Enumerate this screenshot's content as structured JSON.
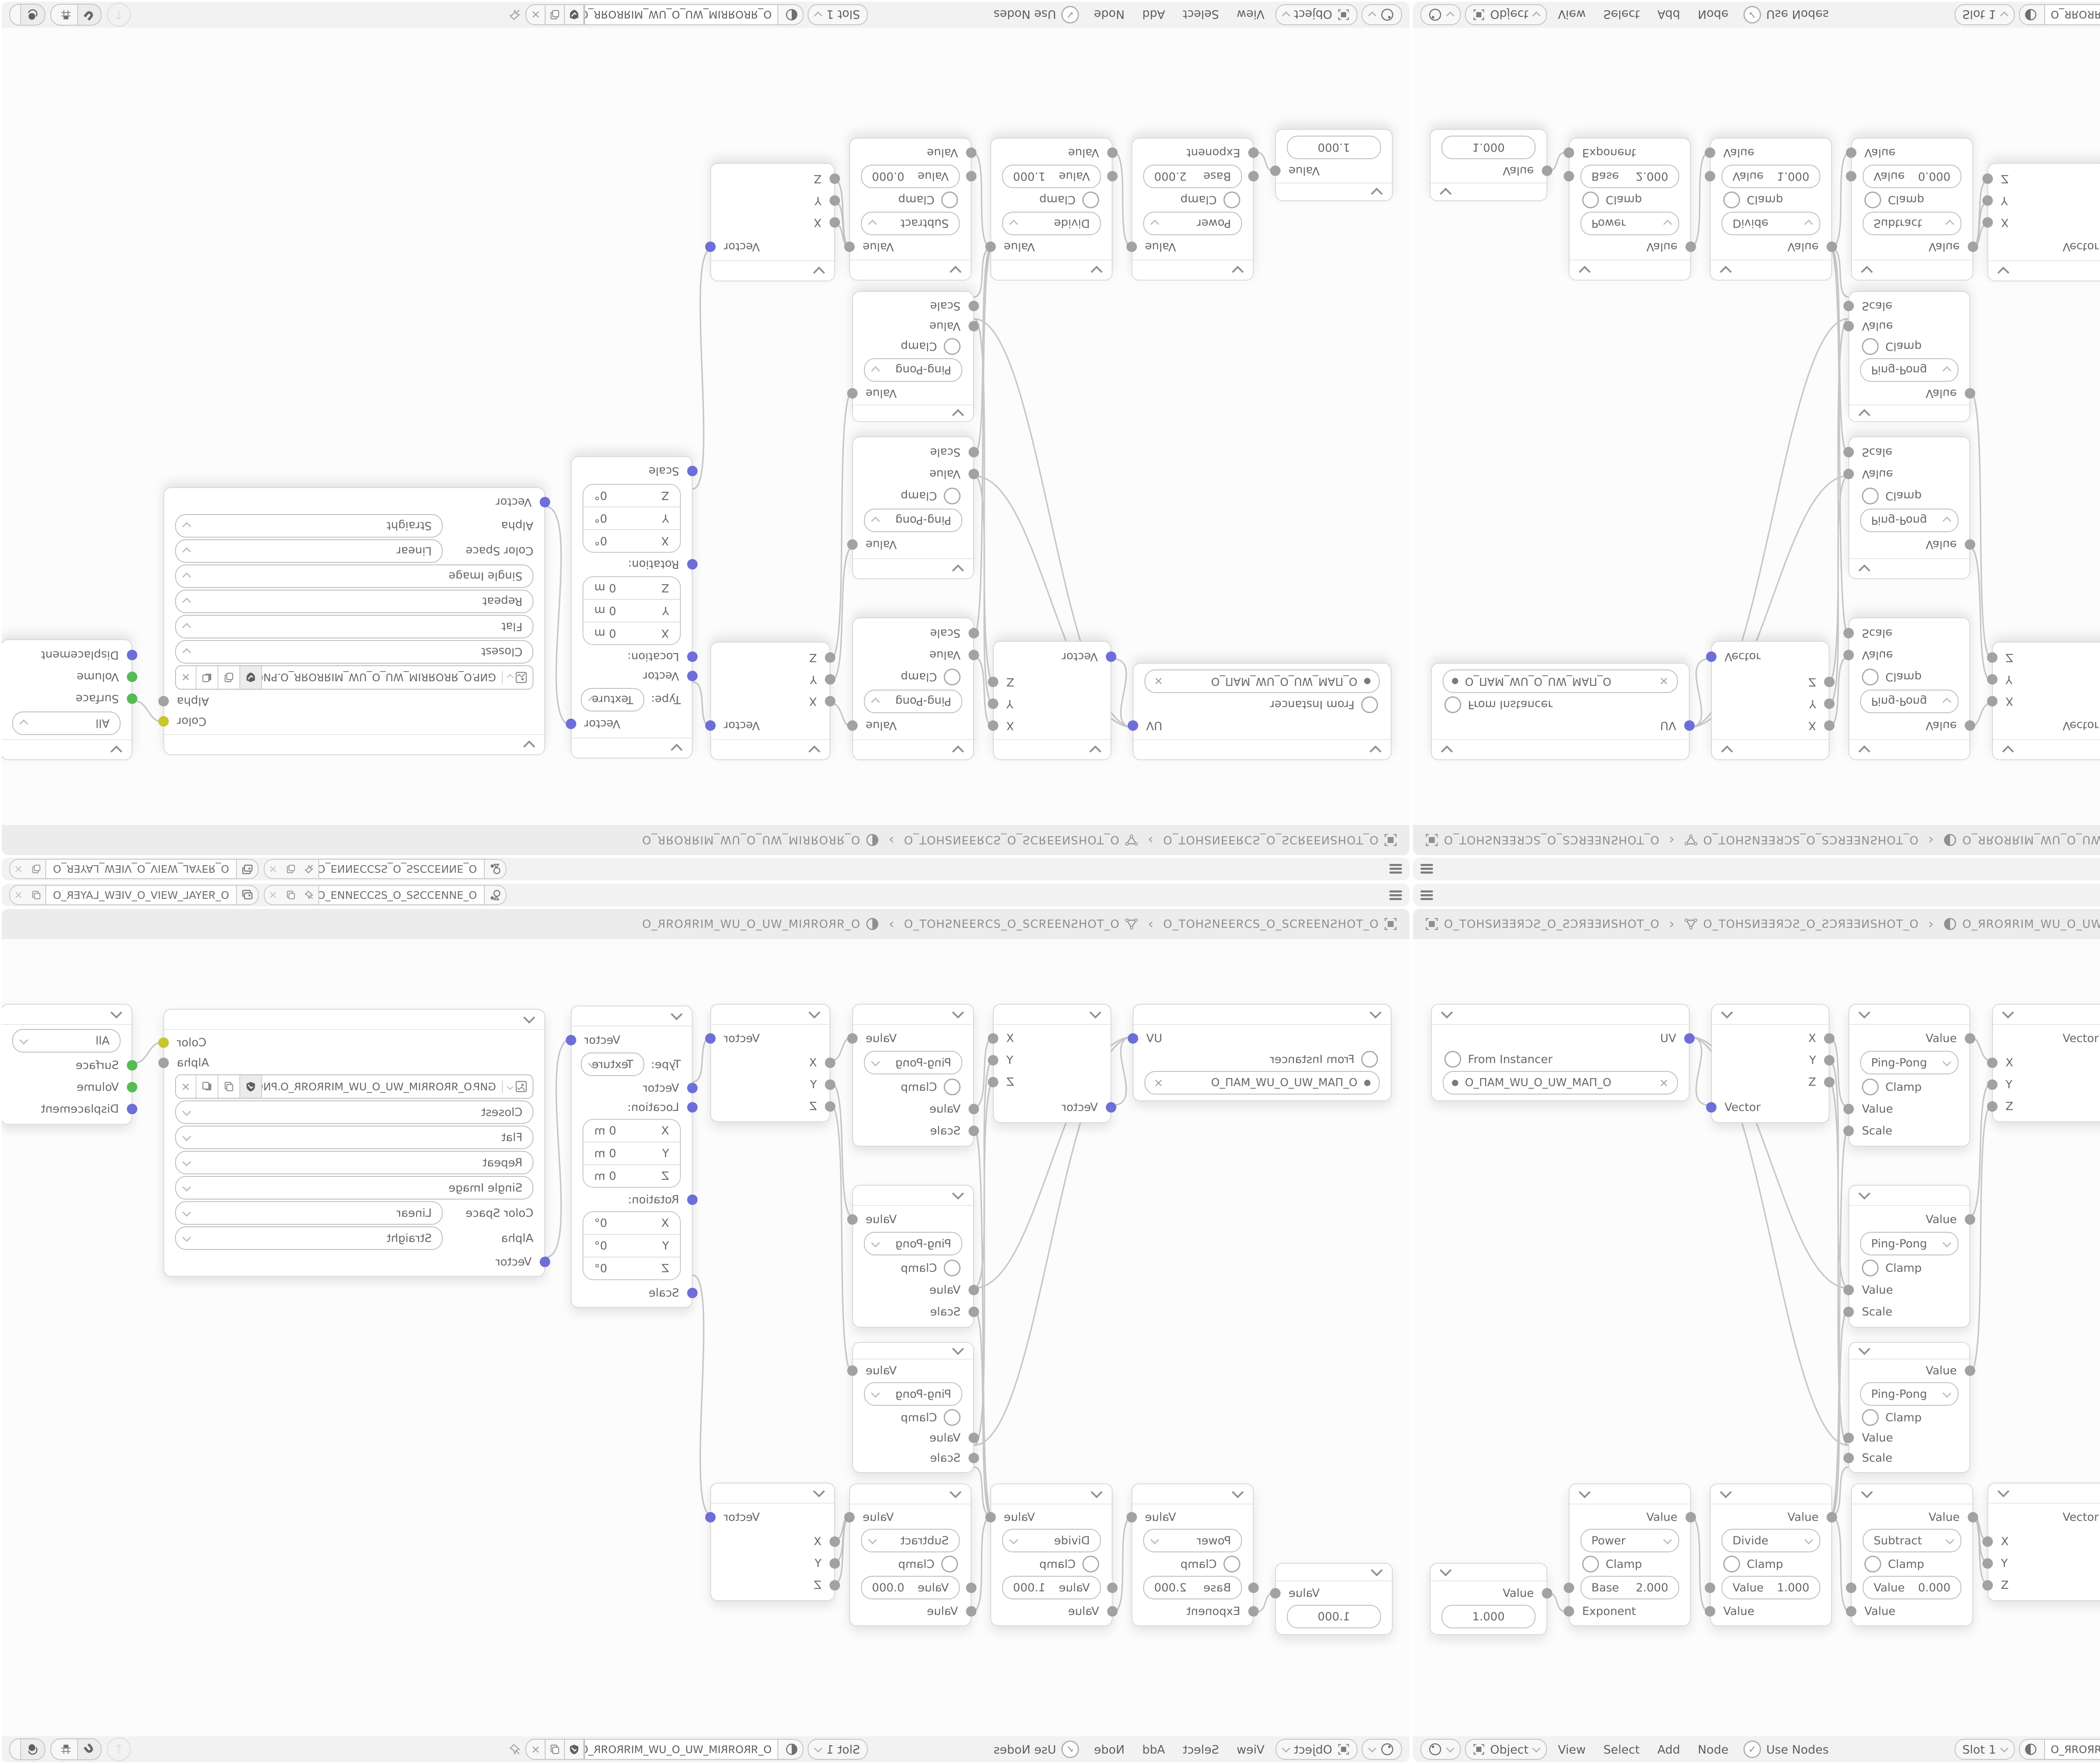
{
  "colors": {
    "socket_vector": "#6e6ed8",
    "socket_shader": "#55bb55",
    "socket_color": "#c6c62f",
    "socket_gray": "#a2a2a2",
    "wire": "#c7c7c7"
  },
  "topbar": {
    "scene_name": "O_ƎИИƎƆƆSƧ_O_ƧSƆƆƎИИƎ_O",
    "view_layer_name": "O_ЯƎYAL_WƎIV_O_VIEW_LAYER_O",
    "close": "×"
  },
  "breadcrumb": {
    "scene": "O_TOHSИƎƎЯƆƧ_O_ƧƆЯƎƎИSHOT_O",
    "object": "O_TOHSИƎƎЯƆƧ_O_ƧƆЯƎƎИSHOT_O",
    "material": "O_ЯROЯRIM_WU_O_UW_MIЯROЯR_O",
    "separator": "›"
  },
  "header": {
    "mode": "Object",
    "menu_view": "View",
    "menu_select": "Select",
    "menu_add": "Add",
    "menu_node": "Node",
    "use_nodes": "Use Nodes",
    "check": "✓",
    "slot": "Slot 1",
    "material": "O_ЯROЯRIM_WU_O_UW_MIЯROЯR_O",
    "close": "×",
    "up_arrow": "↑"
  },
  "nodes": {
    "uv_map": {
      "output": "UV",
      "from_instancer": "From Instancer",
      "uv_name": "O_ПAM_WU_O_UW_MAП_O",
      "close": "×"
    },
    "separate_xyz": {
      "x": "X",
      "y": "Y",
      "z": "Z",
      "vector": "Vector"
    },
    "ping_pong": {
      "output": "Value",
      "operation": "Ping-Pong",
      "clamp": "Clamp",
      "value": "Value",
      "scale": "Scale"
    },
    "combine_xyz": {
      "vector": "Vector",
      "x": "X",
      "y": "Y",
      "z": "Z"
    },
    "mapping": {
      "output": "Vector",
      "type_label": "Type:",
      "type_value": "Texture",
      "vector": "Vector",
      "location": "Location:",
      "rotation": "Rotation:",
      "scale": "Scale",
      "axis_x": "X",
      "axis_y": "Y",
      "axis_z": "Z",
      "zero_m": "0 m",
      "zero_deg": "0°"
    },
    "image_texture": {
      "color": "Color",
      "alpha": "Alpha",
      "filename": "GИP.O_ЯROЯRIM_WU_O_UW_MIЯROЯR_O.PNG",
      "interpolation": "Closest",
      "projection": "Flat",
      "extension": "Repeat",
      "source": "Single Image",
      "color_space_label": "Color Space",
      "color_space": "Linear",
      "alpha_label": "Alpha",
      "alpha_mode": "Straight",
      "vector": "Vector",
      "close": "×"
    },
    "material_output": {
      "target": "All",
      "surface": "Surface",
      "volume": "Volume",
      "displacement": "Displacement"
    },
    "value_node": {
      "output": "Value",
      "value": "1.000"
    },
    "power": {
      "output": "Value",
      "operation": "Power",
      "clamp": "Clamp",
      "base_label": "Base",
      "base": "2.000",
      "exponent": "Exponent"
    },
    "divide": {
      "output": "Value",
      "operation": "Divide",
      "clamp": "Clamp",
      "value_label": "Value",
      "value": "1.000",
      "input": "Value"
    },
    "subtract": {
      "output": "Value",
      "operation": "Subtract",
      "clamp": "Clamp",
      "value_label": "Value",
      "value": "0.000",
      "input": "Value"
    }
  }
}
